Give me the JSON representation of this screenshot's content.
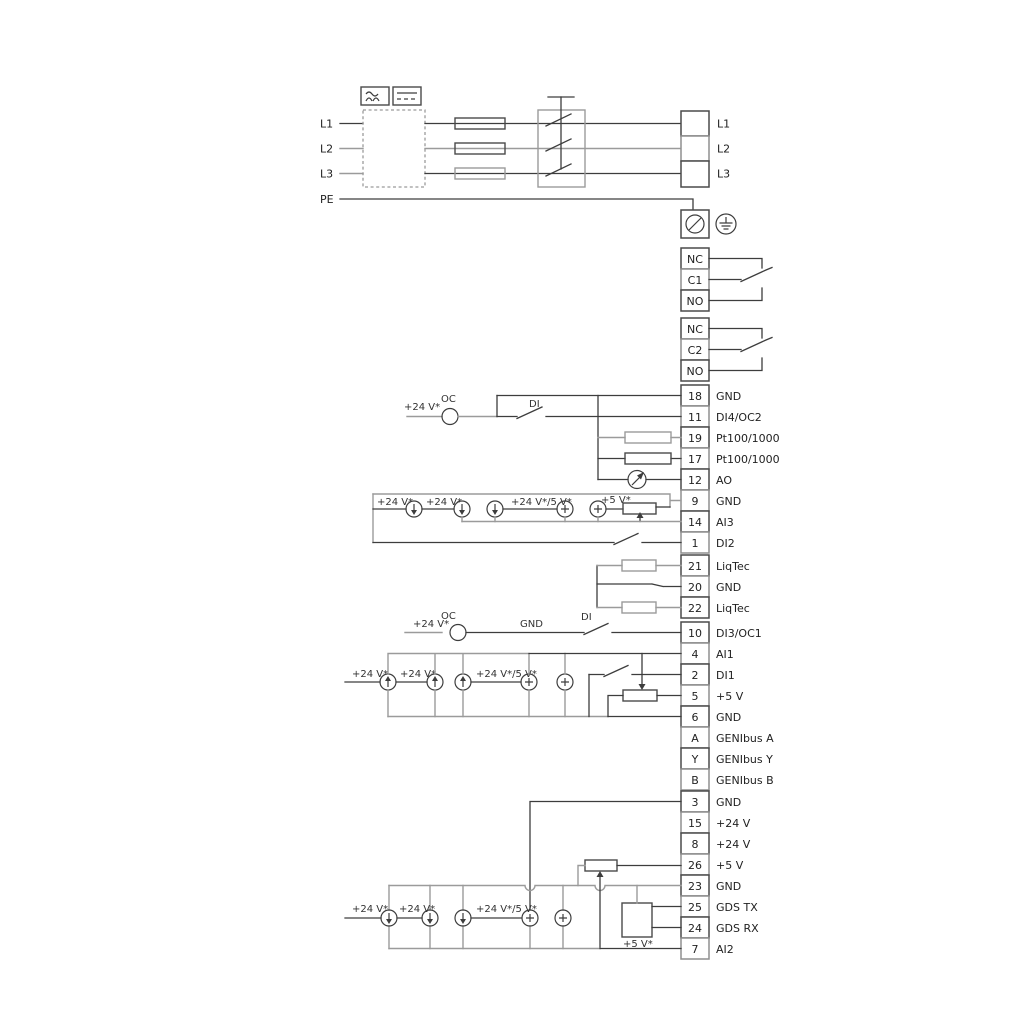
{
  "colors": {
    "wire": "#3d3d3d",
    "wire_gray": "#9b9b9b",
    "background": "#ffffff"
  },
  "power": {
    "left_labels": [
      "L1",
      "L2",
      "L3",
      "PE"
    ],
    "right_labels": [
      "L1",
      "L2",
      "L3"
    ]
  },
  "relays": [
    {
      "rows": [
        "NC",
        "C1",
        "NO"
      ]
    },
    {
      "rows": [
        "NC",
        "C2",
        "NO"
      ]
    }
  ],
  "io_top": {
    "rows": [
      {
        "num": "18",
        "label": "GND"
      },
      {
        "num": "11",
        "label": "DI4/OC2"
      },
      {
        "num": "19",
        "label": "Pt100/1000"
      },
      {
        "num": "17",
        "label": "Pt100/1000"
      },
      {
        "num": "12",
        "label": "AO"
      },
      {
        "num": "9",
        "label": "GND"
      },
      {
        "num": "14",
        "label": "AI3"
      },
      {
        "num": "1",
        "label": "DI2"
      }
    ],
    "ann": {
      "v24_oc": "+24 V*",
      "oc": "OC",
      "di": "DI",
      "src": [
        "+24 V*",
        "+24 V*",
        "+24 V*/5 V*",
        "+5 V*"
      ]
    }
  },
  "liqtec": {
    "rows": [
      {
        "num": "21",
        "label": "LiqTec"
      },
      {
        "num": "20",
        "label": "GND"
      },
      {
        "num": "22",
        "label": "LiqTec"
      }
    ]
  },
  "io_mid": {
    "rows": [
      {
        "num": "10",
        "label": "DI3/OC1"
      },
      {
        "num": "4",
        "label": "AI1"
      },
      {
        "num": "2",
        "label": "DI1"
      },
      {
        "num": "5",
        "label": "+5 V"
      },
      {
        "num": "6",
        "label": "GND"
      },
      {
        "num": "A",
        "label": "GENIbus A"
      },
      {
        "num": "Y",
        "label": "GENIbus Y"
      },
      {
        "num": "B",
        "label": "GENIbus B"
      }
    ],
    "ann": {
      "v24_oc": "+24 V*",
      "oc": "OC",
      "gnd": "GND",
      "di": "DI",
      "src": [
        "+24 V*",
        "+24 V*",
        "+24 V*/5 V*"
      ]
    }
  },
  "io_bottom": {
    "rows": [
      {
        "num": "3",
        "label": "GND"
      },
      {
        "num": "15",
        "label": "+24 V"
      },
      {
        "num": "8",
        "label": "+24 V"
      },
      {
        "num": "26",
        "label": "+5 V"
      },
      {
        "num": "23",
        "label": "GND"
      },
      {
        "num": "25",
        "label": "GDS TX"
      },
      {
        "num": "24",
        "label": "GDS RX"
      },
      {
        "num": "7",
        "label": "AI2"
      }
    ],
    "ann": {
      "src": [
        "+24 V*",
        "+24 V*",
        "+24 V*/5 V*"
      ],
      "v5": "+5 V*"
    }
  }
}
